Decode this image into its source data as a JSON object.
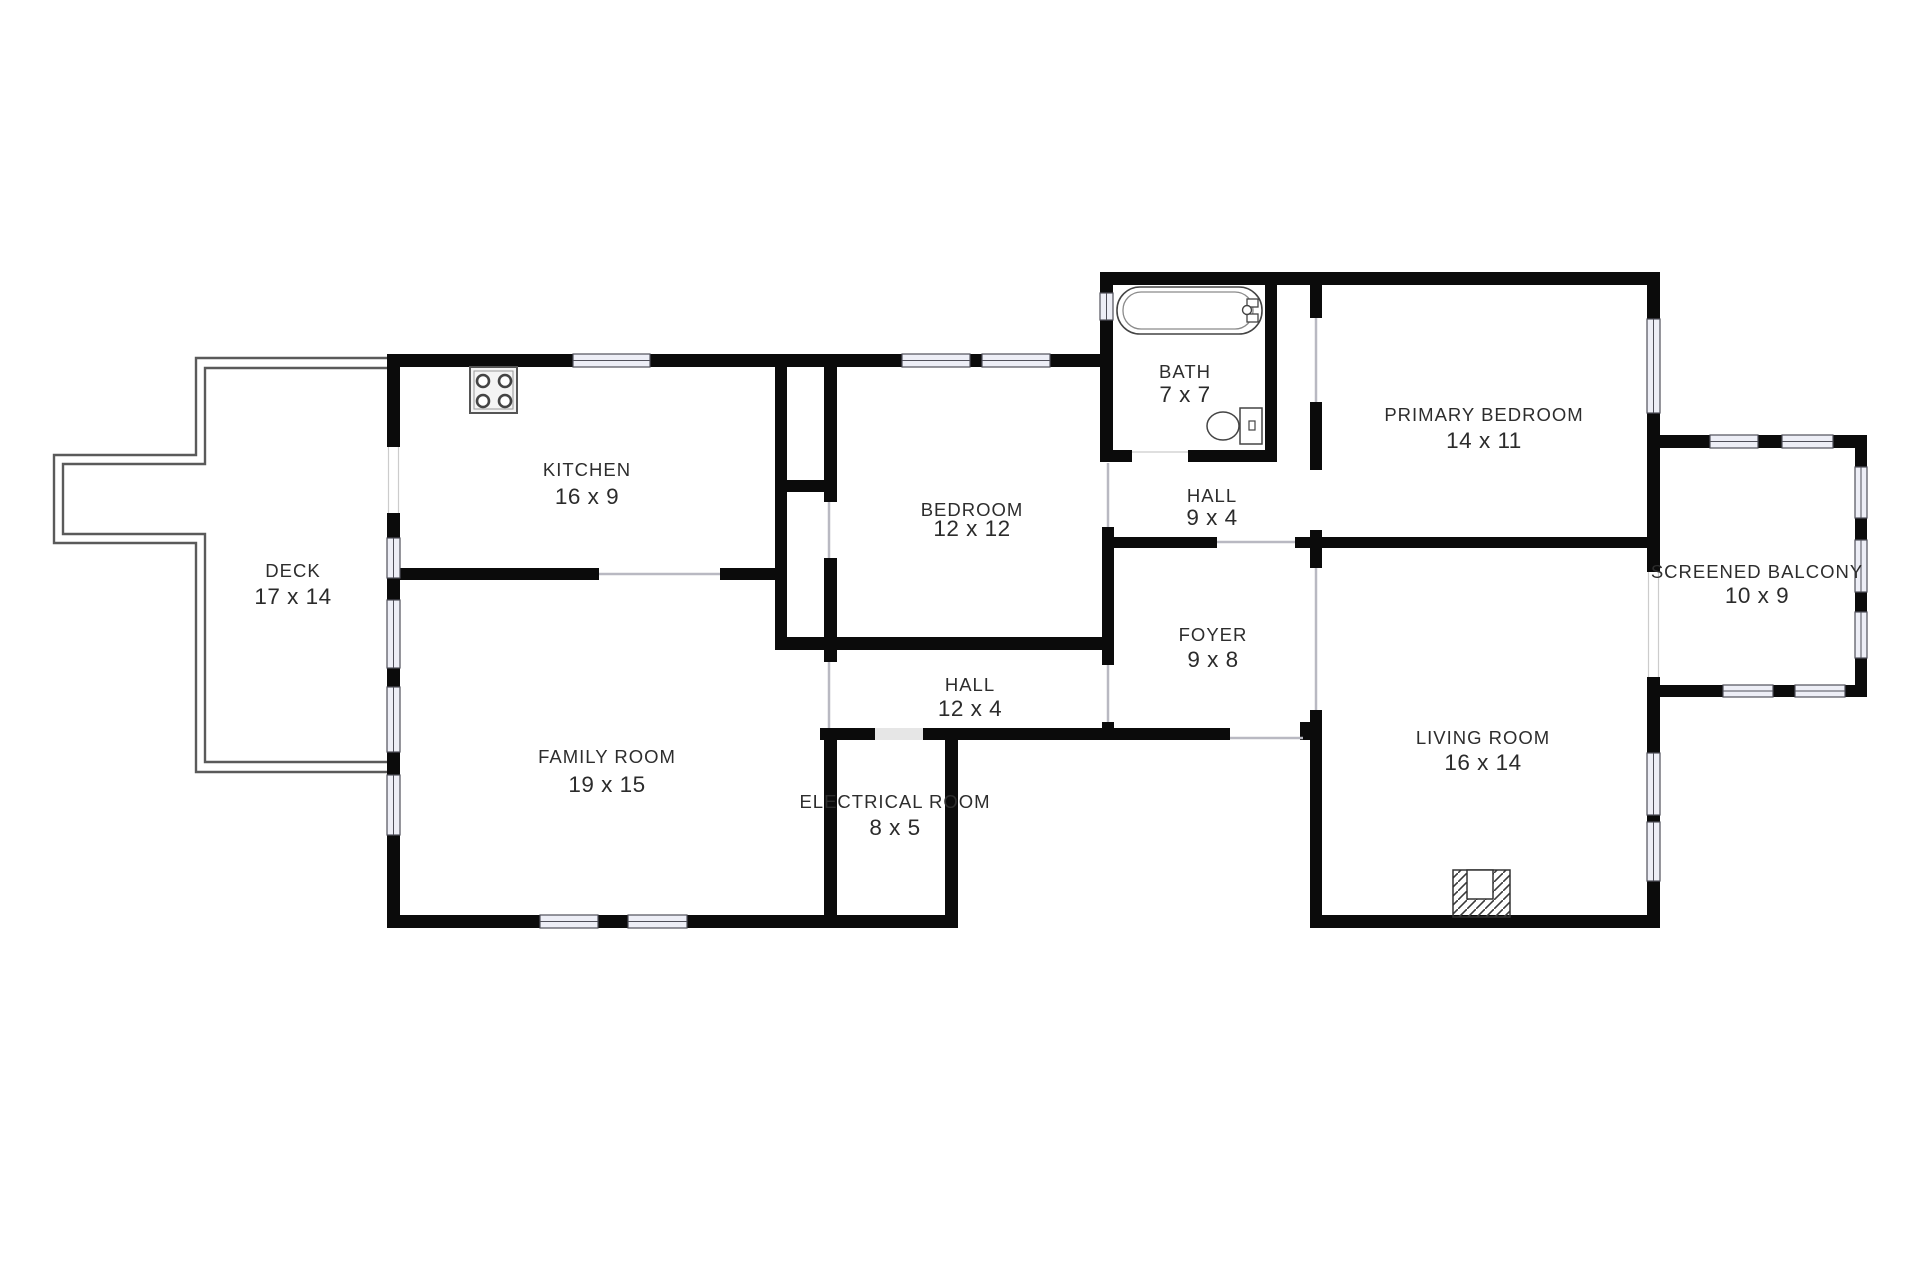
{
  "plan": {
    "type": "residential-floor-plan",
    "rooms": [
      {
        "id": "deck",
        "name": "DECK",
        "dims": "17 x 14"
      },
      {
        "id": "kitchen",
        "name": "KITCHEN",
        "dims": "16 x 9"
      },
      {
        "id": "bedroom",
        "name": "BEDROOM",
        "dims": "12 x 12"
      },
      {
        "id": "bath",
        "name": "BATH",
        "dims": "7 x 7"
      },
      {
        "id": "hall-upper",
        "name": "HALL",
        "dims": "9 x 4"
      },
      {
        "id": "primary-bedroom",
        "name": "PRIMARY BEDROOM",
        "dims": "14 x 11"
      },
      {
        "id": "screened-balcony",
        "name": "SCREENED BALCONY",
        "dims": "10 x 9"
      },
      {
        "id": "foyer",
        "name": "FOYER",
        "dims": "9 x 8"
      },
      {
        "id": "hall-lower",
        "name": "HALL",
        "dims": "12 x 4"
      },
      {
        "id": "family-room",
        "name": "FAMILY ROOM",
        "dims": "19 x 15"
      },
      {
        "id": "electrical-room",
        "name": "ELECTRICAL ROOM",
        "dims": "8 x 5"
      },
      {
        "id": "living-room",
        "name": "LIVING ROOM",
        "dims": "16 x 14"
      }
    ],
    "fixtures": [
      {
        "icon": "stove-icon",
        "location": "kitchen"
      },
      {
        "icon": "bathtub-icon",
        "location": "bath"
      },
      {
        "icon": "toilet-icon",
        "location": "bath"
      },
      {
        "icon": "fireplace-icon",
        "location": "living-room"
      }
    ],
    "colors": {
      "wall": "#0b0b0b",
      "floor": "#ffffff",
      "window_fill": "#edeef6",
      "window_frame": "#50505a",
      "deck_outline": "#5a5a5a",
      "label_text": "#2d2d2d"
    }
  }
}
